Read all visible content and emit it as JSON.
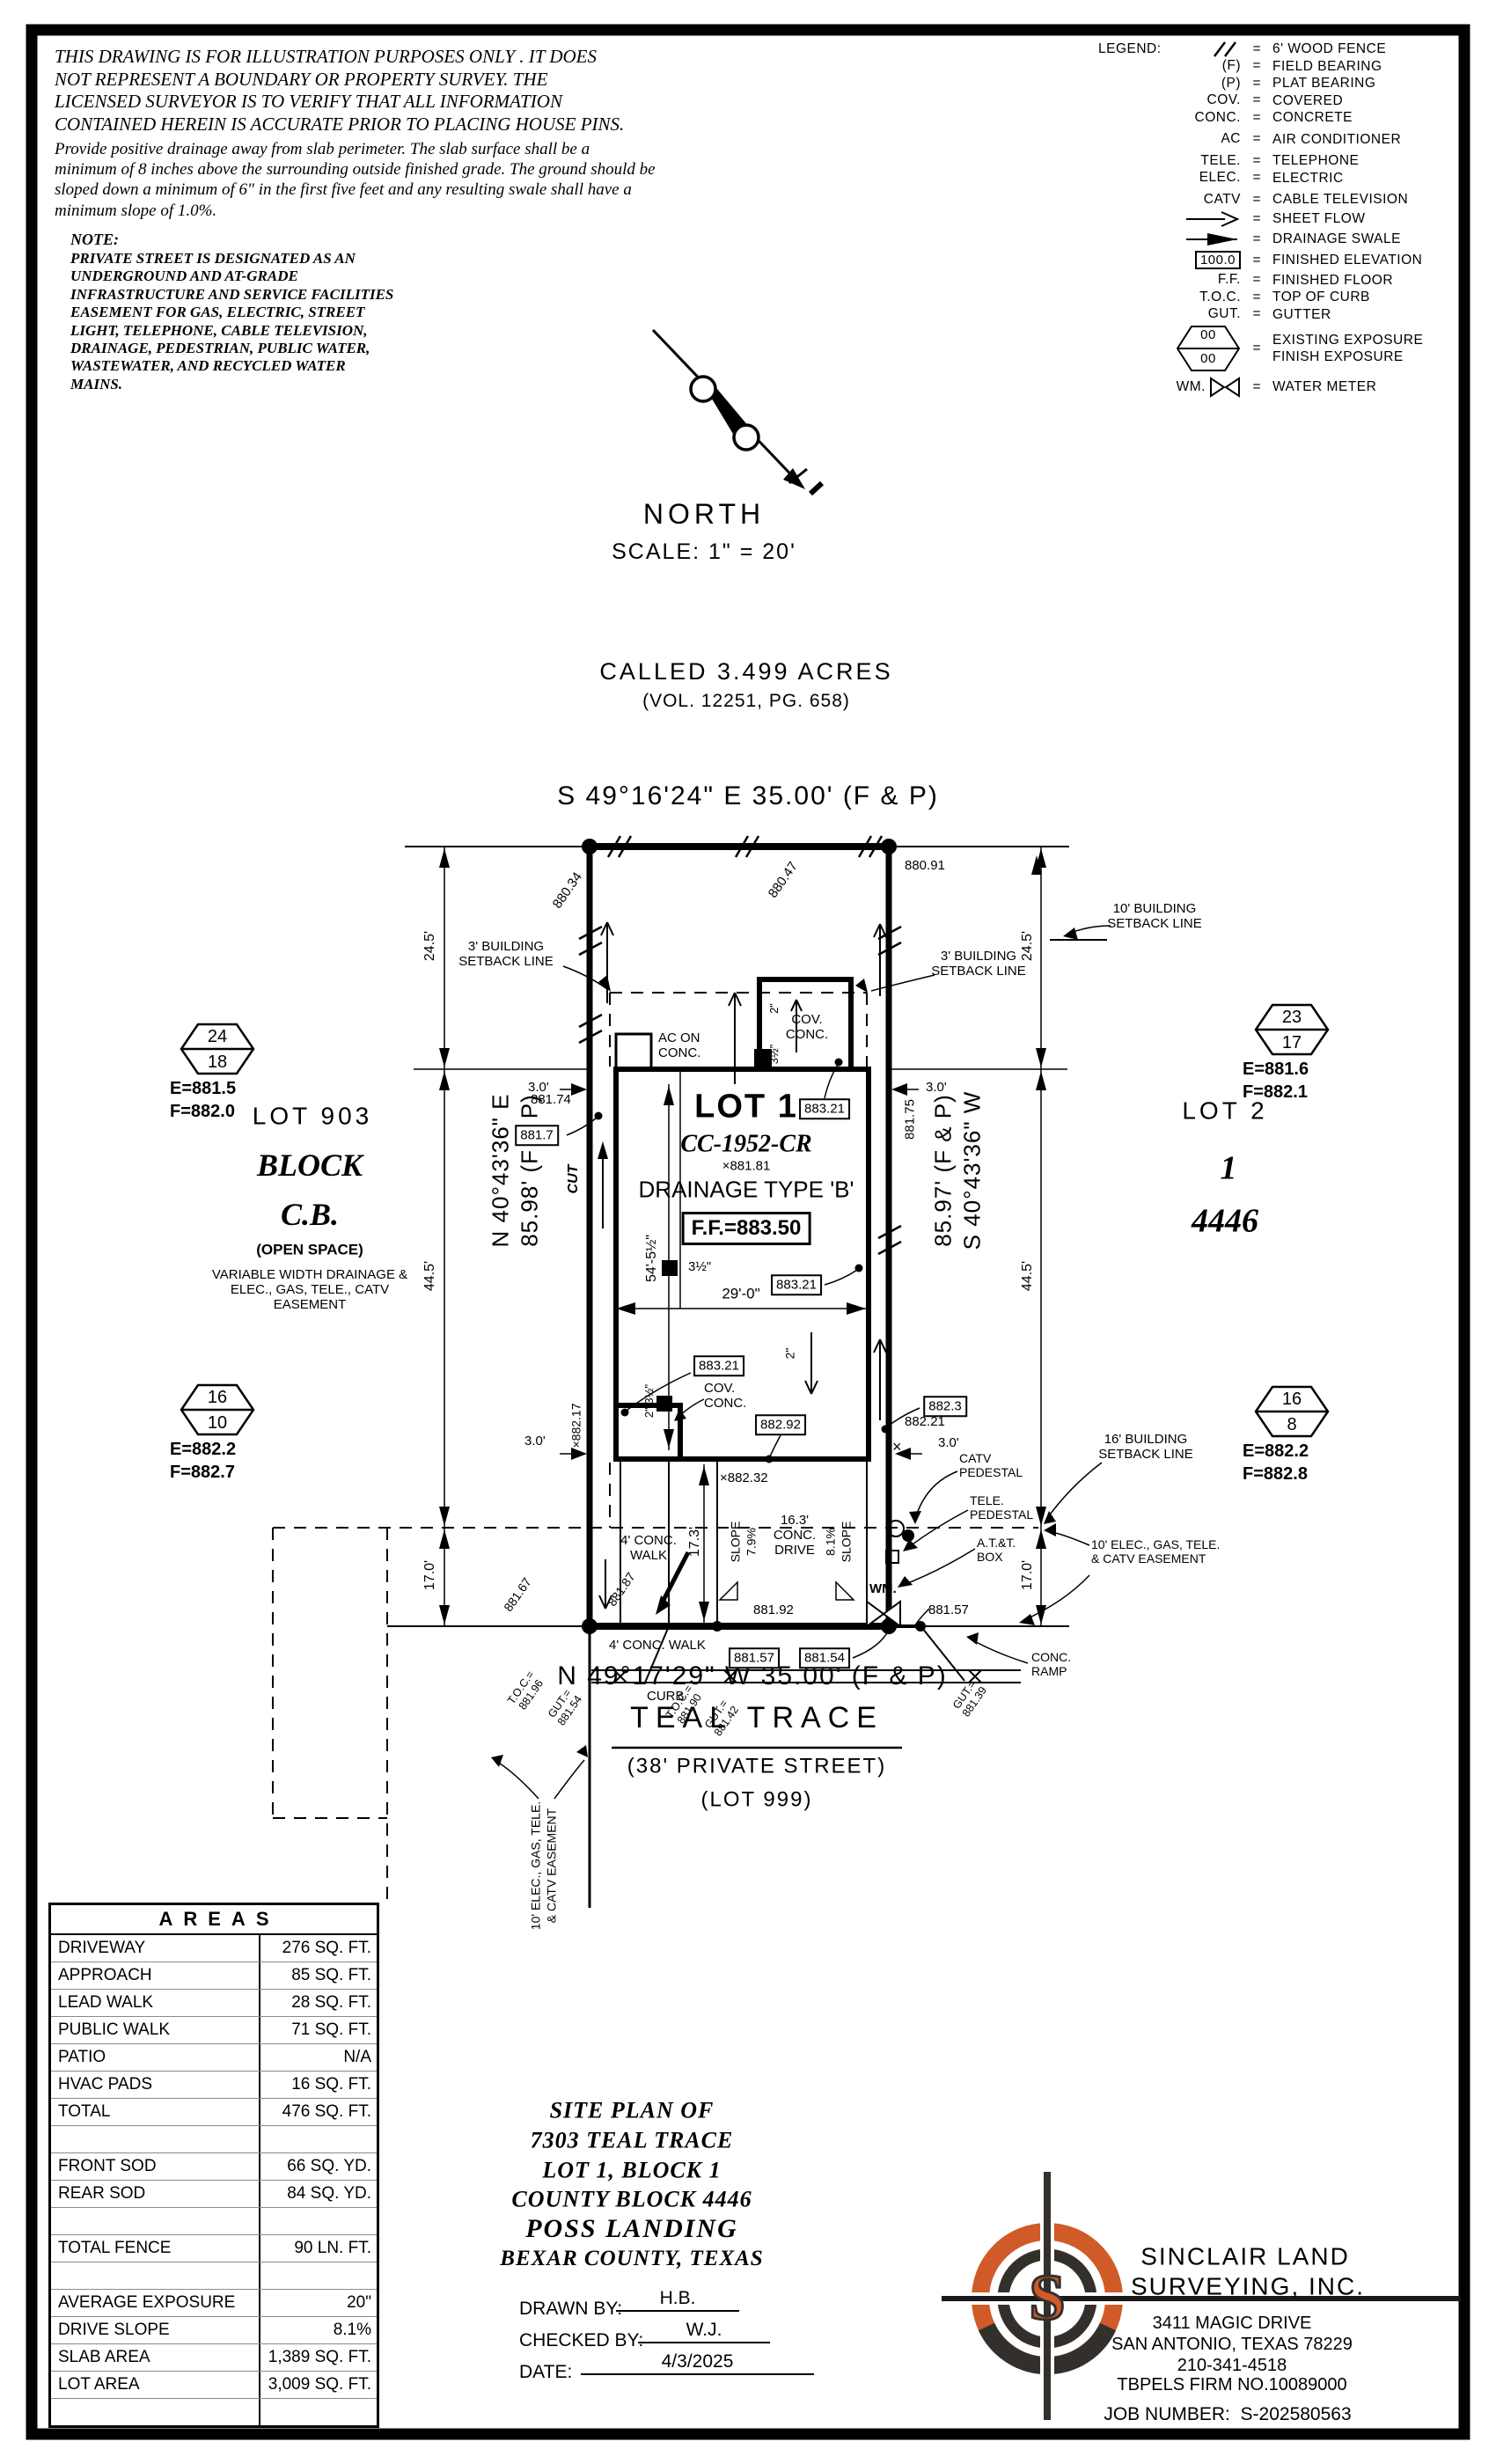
{
  "disclaimer": {
    "para1": "THIS DRAWING IS FOR ILLUSTRATION PURPOSES ONLY . IT DOES\nNOT REPRESENT A BOUNDARY OR PROPERTY SURVEY. THE\nLICENSED SURVEYOR IS TO VERIFY THAT ALL INFORMATION\nCONTAINED HEREIN IS ACCURATE PRIOR TO PLACING HOUSE PINS.",
    "para2": "Provide positive drainage away from slab perimeter. The slab surface shall be a\nminimum of 8 inches above the surrounding outside finished grade. The ground should be\nsloped down a minimum of 6\" in the first five feet and any resulting swale shall have a\nminimum slope of 1.0%.",
    "note_title": "NOTE:",
    "note_body": "PRIVATE STREET IS DESIGNATED AS AN\nUNDERGROUND AND AT-GRADE\nINFRASTRUCTURE AND SERVICE FACILITIES\nEASEMENT FOR GAS, ELECTRIC, STREET\nLIGHT, TELEPHONE, CABLE TELEVISION,\nDRAINAGE, PEDESTRIAN, PUBLIC WATER,\nWASTEWATER, AND RECYCLED WATER\nMAINS."
  },
  "legend": {
    "label": "LEGEND:",
    "eq": "=",
    "elev_sample": "100.0",
    "exposure_existing": "00",
    "exposure_finish": "00",
    "rows": [
      {
        "sym": "",
        "desc": "6' WOOD FENCE",
        "icon": "wood-fence"
      },
      {
        "sym": "(F)",
        "desc": "FIELD BEARING"
      },
      {
        "sym": "(P)",
        "desc": "PLAT BEARING"
      },
      {
        "sym": "COV.",
        "desc": "COVERED"
      },
      {
        "sym": "CONC.",
        "desc": "CONCRETE"
      },
      {
        "sym": "AC",
        "desc": "AIR CONDITIONER"
      },
      {
        "sym": "TELE.",
        "desc": "TELEPHONE"
      },
      {
        "sym": "ELEC.",
        "desc": "ELECTRIC"
      },
      {
        "sym": "CATV",
        "desc": "CABLE TELEVISION"
      },
      {
        "sym": "",
        "desc": "SHEET FLOW",
        "icon": "sheet-flow-arrow"
      },
      {
        "sym": "",
        "desc": "DRAINAGE SWALE",
        "icon": "drainage-swale-arrow"
      },
      {
        "sym": "",
        "desc": "FINISHED ELEVATION",
        "icon": "finished-elevation-box"
      },
      {
        "sym": "F.F.",
        "desc": "FINISHED FLOOR"
      },
      {
        "sym": "T.O.C.",
        "desc": "TOP OF CURB"
      },
      {
        "sym": "GUT.",
        "desc": "GUTTER"
      },
      {
        "sym": "",
        "desc": "EXISTING EXPOSURE\nFINISH EXPOSURE",
        "icon": "exposure-hexagon"
      },
      {
        "sym": "WM.",
        "desc": "WATER METER",
        "icon": "water-meter-bowtie"
      }
    ]
  },
  "compass": {
    "label": "NORTH",
    "scale": "SCALE: 1\" = 20'"
  },
  "parent_tract": {
    "acreage": "CALLED 3.499 ACRES",
    "volume": "(VOL. 12251, PG. 658)"
  },
  "plat": {
    "bearings": {
      "top": "S 49°16'24\" E 35.00' (F & P)",
      "bottom": "N 49°17'29\" W 35.00' (F & P)",
      "left_bearing": "N 40°43'36\" E",
      "left_distance": "85.98' (F & P)",
      "right_distance": "85.97' (F & P)",
      "right_bearing": "S 40°43'36\" W"
    },
    "dims": {
      "d24_5_left": "24.5'",
      "d24_5_right": "24.5'",
      "d44_5_left": "44.5'",
      "d44_5_right": "44.5'",
      "d17_0_left": "17.0'",
      "d17_0_right": "17.0'",
      "d3_0_nw": "3.0'",
      "d3_0_ne": "3.0'",
      "d3_0_sw": "3.0'",
      "d3_0_se": "3.0'",
      "d29_0": "29'-0\"",
      "d54_5": "54'-5½\"",
      "d17_3": "17.3'",
      "d2_porch": "2\"",
      "d3h_porch": "3½\"",
      "d2_mid": "2\"",
      "d3h_mid": "3½\"",
      "d2_3h_sw": "2\" 3½\""
    },
    "setbacks": {
      "s3_left": "3' BUILD​ING\nSETBACK LINE",
      "s3_right": "3' BUILDING\nSETBACK LINE",
      "s10_right": "10' BUILDING\nSETBACK LINE",
      "s16_right": "16' BUILDING\nSETBACK LINE"
    },
    "house": {
      "lot": "LOT 1",
      "plan": "CC-1952-CR",
      "drainage": "DRAINAGE TYPE 'B'",
      "ff": "F.F.=883.50",
      "ac": "AC ON\nCONC.",
      "cov_top": "COV.\nCONC.",
      "cov_bottom": "COV.\nCONC."
    },
    "elevations": {
      "e880_34": "880.34",
      "e880_47": "880.47",
      "e880_91": "880.91",
      "e881_74": "881.74",
      "e881_75": "881.75",
      "e881_7": "881.7",
      "e881_81": "×881.81",
      "b883_21a": "883.21",
      "b883_21b": "883.21",
      "b883_21c": "883.21",
      "b882_92": "882.92",
      "b882_3": "882.3",
      "e882_21": "882.21",
      "x882_17": "×882.17",
      "x882_32": "×882.32",
      "x_mark": "×",
      "e881_87": "881.87",
      "e881_92": "881.92",
      "e881_67": "881.67",
      "e881_57_right": "881.57",
      "b881_57": "881.57",
      "b881_54": "881.54",
      "toc1": "T.O.C.=\n881.96",
      "gut1": "GUT.=\n881.54",
      "toc2": "T.O.C.=\n881.90",
      "gut2": "GUT.=\n881.42",
      "gut3": "GUT.=\n881.39"
    },
    "flow": {
      "cut": "CUT"
    },
    "site": {
      "walk_vert": "4' CONC.\nWALK",
      "walk_horiz": "4' CONC. WALK",
      "drive": "16.3'\nCONC.\nDRIVE",
      "slope_left": "SLOPE\n7.9%",
      "slope_right": "8.1%\nSLOPE",
      "curb": "CURB",
      "ramp": "CONC.\nRAMP",
      "wm": "WM.",
      "catv": "CATV\nPEDESTAL",
      "tele": "TELE.\nPEDESTAL",
      "att": "A.T.&T.\nBOX"
    },
    "easements": {
      "right": "10' ELEC., GAS, TELE.\n& CATV EASEMENT",
      "bottom": "10' ELEC., GAS, TELE.\n& CATV EASEMENT"
    }
  },
  "markers": {
    "nw": {
      "top": "24",
      "bottom": "18",
      "e": "E=881.5",
      "f": "F=882.0"
    },
    "ne": {
      "top": "23",
      "bottom": "17",
      "e": "E=881.6",
      "f": "F=882.1"
    },
    "sw": {
      "top": "16",
      "bottom": "10",
      "e": "E=882.2",
      "f": "F=882.7"
    },
    "se": {
      "top": "16",
      "bottom": "8",
      "e": "E=882.2",
      "f": "F=882.8"
    }
  },
  "adjacent": {
    "west": {
      "lot": "LOT 903",
      "block_line1": "BLOCK",
      "block_line2": "C.B.",
      "open": "(OPEN SPACE)",
      "easement": "VARIABLE WIDTH DRAINAGE &\nELEC., GAS, TELE., CATV\nEASEMENT"
    },
    "east": {
      "lot": "LOT 2",
      "block": "1",
      "county_block": "4446"
    }
  },
  "street": {
    "name": "TEAL TRACE",
    "type": "(38' PRIVATE STREET)",
    "lot": "(LOT 999)"
  },
  "areas": {
    "title": "AREAS",
    "rows": [
      {
        "label": "DRIVEWAY",
        "value": "276 SQ. FT."
      },
      {
        "label": "APPROACH",
        "value": "85 SQ. FT."
      },
      {
        "label": "LEAD WALK",
        "value": "28 SQ. FT."
      },
      {
        "label": "PUBLIC WALK",
        "value": "71 SQ. FT."
      },
      {
        "label": "PATIO",
        "value": "N/A"
      },
      {
        "label": "HVAC PADS",
        "value": "16 SQ. FT."
      },
      {
        "label": "TOTAL",
        "value": "476 SQ. FT."
      },
      {
        "label": "",
        "value": ""
      },
      {
        "label": "FRONT SOD",
        "value": "66 SQ. YD."
      },
      {
        "label": "REAR SOD",
        "value": "84 SQ. YD."
      },
      {
        "label": "",
        "value": ""
      },
      {
        "label": "TOTAL FENCE",
        "value": "90 LN. FT."
      },
      {
        "label": "",
        "value": ""
      },
      {
        "label": "AVERAGE EXPOSURE",
        "value": "20\""
      },
      {
        "label": "DRIVE SLOPE",
        "value": "8.1%"
      },
      {
        "label": "SLAB AREA",
        "value": "1,389 SQ. FT."
      },
      {
        "label": "LOT AREA",
        "value": "3,009 SQ. FT."
      },
      {
        "label": "",
        "value": ""
      }
    ]
  },
  "title_block": {
    "l1": "SITE PLAN OF",
    "l2": "7303 TEAL TRACE",
    "l3": "LOT 1, BLOCK 1",
    "l4": "COUNTY BLOCK 4446",
    "l5": "POSS LANDING",
    "l6": "BEXAR COUNTY, TEXAS",
    "drawn_label": "DRAWN BY:",
    "drawn": "H.B.",
    "checked_label": "CHECKED BY:",
    "checked": "W.J.",
    "date_label": "DATE:",
    "date": "4/3/2025"
  },
  "firm": {
    "logo_letter": "S",
    "name1": "SINCLAIR LAND",
    "name2": "SURVEYING, INC.",
    "addr1": "3411 MAGIC DRIVE",
    "addr2": "SAN ANTONIO, TEXAS 78229",
    "phone": "210-341-4518",
    "tbpels": "TBPELS FIRM NO.10089000",
    "job": "JOB NUMBER:  S-202580563"
  },
  "colors": {
    "ink": "#000000",
    "logo_orange": "#d05a28",
    "logo_dark": "#33302c",
    "paper": "#ffffff"
  }
}
